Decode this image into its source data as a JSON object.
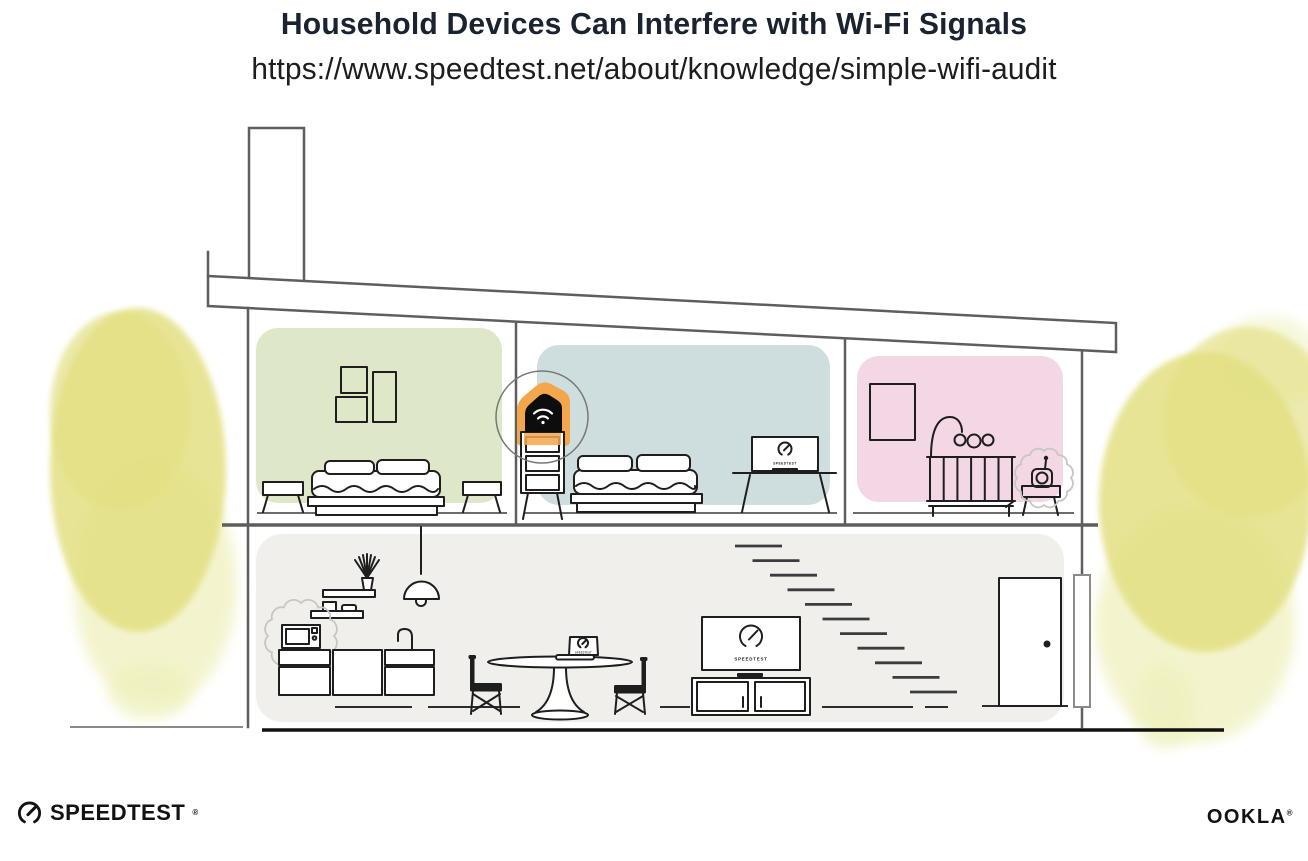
{
  "header": {
    "title": "Household Devices Can Interfere with Wi-Fi Signals",
    "url": "https://www.speedtest.net/about/knowledge/simple-wifi-audit"
  },
  "screens": {
    "tv_label": "SPEEDTEST",
    "monitor_label": "SPEEDTEST",
    "laptop_label": "SPEEDTEST"
  },
  "footer": {
    "speedtest_wordmark": "SPEEDTEST",
    "speedtest_reg": "®",
    "ookla_wordmark": "OOKLA",
    "ookla_reg": "®"
  },
  "icons": {
    "router": "wifi-icon",
    "footer_logo": "gauge-icon",
    "tv_screen": "gauge-icon",
    "monitor_screen": "gauge-icon",
    "laptop_screen": "gauge-icon"
  },
  "colors": {
    "accent_orange": "#F4A64C",
    "room_green": "#DEE8C9",
    "room_blue": "#CEDEDF",
    "room_pink": "#F3D7E5",
    "floor_gray": "#F0EFEC",
    "tree_yellow": "#E3E083",
    "tree_yellow_light": "#F0F1BE",
    "structure_gray": "#5E5E5C",
    "furniture_ink": "#1E1E1E",
    "burst_gray": "#C7C6C2",
    "title_ink": "#1B2230",
    "text_ink": "#1D1D1D"
  }
}
